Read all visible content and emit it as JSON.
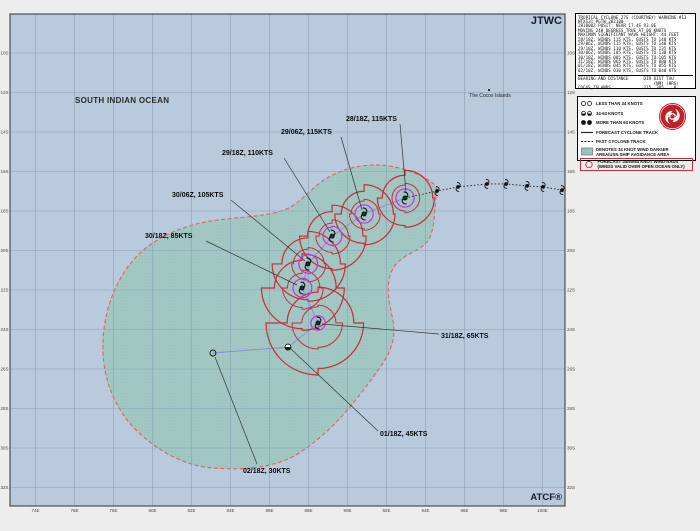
{
  "map_overlays": {
    "jtwc": "JTWC",
    "atcf": "ATCF®",
    "ocean_label": "SOUTH INDIAN OCEAN",
    "cocos_label": "The Cocos Islands"
  },
  "warning_box": {
    "lines": [
      "TROPICAL CYCLONE 27S (COURTNEY) WARNING #13",
      "WTXS31 PGTW 282100",
      "281800Z POSIT: NEAR 17.4S 93.0E",
      "MOVING 240 DEGREES TRUE AT 06 KNOTS",
      "MAXIMUM SIGNIFICANT WAVE HEIGHT: 44 FEET",
      "28/18Z, WINDS 115 KTS, GUSTS TO 140 KTS",
      "29/06Z, WINDS 115 KTS, GUSTS TO 140 KTS",
      "29/18Z, WINDS 110 KTS, GUSTS TO 135 KTS",
      "30/06Z, WINDS 105 KTS, GUSTS TO 130 KTS",
      "30/18Z, WINDS 085 KTS, GUSTS TO 105 KTS",
      "31/18Z, WINDS 065 KTS, GUSTS TO 080 KTS",
      "01/18Z, WINDS 045 KTS, GUSTS TO 055 KTS",
      "02/18Z, WINDS 030 KTS, GUSTS TO 040 KTS"
    ],
    "bearing": {
      "header": "BEARING AND DISTANCE      DIR DIST TAU",
      "units": "                              (NM) (HRS)",
      "row": "COCOS_ISLANDS             215  385    0"
    }
  },
  "legend": {
    "items": [
      {
        "icon": "open-circles",
        "label": "LESS THAN 34 KNOTS"
      },
      {
        "icon": "half-circles",
        "label": "34-63 KNOTS"
      },
      {
        "icon": "filled-circles",
        "label": "MORE THAN 63 KNOTS"
      },
      {
        "icon": "solid-line",
        "label": "FORECAST CYCLONE TRACK"
      },
      {
        "icon": "dashed-line",
        "label": "PAST CYCLONE TRACK"
      },
      {
        "icon": "hatched-box",
        "label": "DENOTES 34 KNOT WIND DANGER\nAREA/USN SHIP AVOIDANCE AREA"
      },
      {
        "icon": "radii-circle",
        "label": "FORECAST 34/50/64 KNOT WIND RADII\n(WINDS VALID OVER OPEN OCEAN ONLY)",
        "boxed": true
      }
    ]
  },
  "chart_data": {
    "type": "cyclone-forecast-track",
    "storm": {
      "id": "27S",
      "name": "COURTNEY",
      "warning_number": 13
    },
    "colors": {
      "map_bg": "#b9cadd",
      "grid": "#8aa0b5",
      "danger_fill": "#a3c8c3",
      "danger_dot": "#7fb0aa",
      "danger_border": "#e2615f",
      "radii_34_50": "#c82c3c",
      "radii_64": "#cf2fd6",
      "forecast_track": "#8691d4",
      "past_track": "#1a1a1a",
      "leader": "#333333"
    },
    "map": {
      "lon_ticks": [
        74,
        76,
        78,
        80,
        82,
        84,
        86,
        88,
        90,
        92,
        94,
        96,
        98,
        100
      ],
      "lat_ticks": [
        10,
        12,
        14,
        16,
        18,
        20,
        22,
        24,
        26,
        28,
        30,
        32
      ],
      "cocos_islands": {
        "lat": 11.97,
        "lon": 97.33
      }
    },
    "past_track": [
      {
        "lon": 94.59,
        "lat": 16.99
      },
      {
        "lon": 95.67,
        "lat": 16.78
      },
      {
        "lon": 97.15,
        "lat": 16.63
      },
      {
        "lon": 98.13,
        "lat": 16.63
      },
      {
        "lon": 99.21,
        "lat": 16.73
      },
      {
        "lon": 100.03,
        "lat": 16.78
      },
      {
        "lon": 101.0,
        "lat": 16.94
      }
    ],
    "forecast": [
      {
        "dtg": "28/18Z",
        "intensity_kt": 115,
        "label": "28/18Z, 115KTS",
        "wind_class": "hurricane",
        "lat": 17.34,
        "lon": 92.95,
        "r34": [
          85,
          90,
          85,
          70
        ],
        "r50": [
          45,
          45,
          40,
          40
        ],
        "r64": [
          28,
          28,
          28,
          28
        ],
        "label_px": [
          346,
          121
        ],
        "leader": [
          [
            400,
            124
          ],
          [
            406,
            193
          ]
        ]
      },
      {
        "dtg": "29/06Z",
        "intensity_kt": 115,
        "label": "29/06Z, 115KTS",
        "wind_class": "hurricane",
        "lat": 18.15,
        "lon": 90.85,
        "r34": [
          90,
          95,
          90,
          70
        ],
        "r50": [
          45,
          50,
          45,
          40
        ],
        "r64": [
          28,
          28,
          28,
          28
        ],
        "label_px": [
          281,
          134
        ],
        "leader": [
          [
            341,
            137
          ],
          [
            362,
            210
          ]
        ]
      },
      {
        "dtg": "29/18Z",
        "intensity_kt": 110,
        "label": "29/18Z, 110KTS",
        "wind_class": "hurricane",
        "lat": 19.27,
        "lon": 89.21,
        "r34": [
          95,
          105,
          100,
          75
        ],
        "r50": [
          50,
          55,
          50,
          40
        ],
        "r64": [
          30,
          30,
          28,
          28
        ],
        "label_px": [
          222,
          155
        ],
        "leader": [
          [
            284,
            158
          ],
          [
            330,
            232
          ]
        ]
      },
      {
        "dtg": "30/06Z",
        "intensity_kt": 105,
        "label": "30/06Z, 105KTS",
        "wind_class": "hurricane",
        "lat": 20.68,
        "lon": 87.97,
        "r34": [
          100,
          115,
          110,
          80
        ],
        "r50": [
          50,
          55,
          50,
          45
        ],
        "r64": [
          30,
          30,
          28,
          28
        ],
        "label_px": [
          172,
          197
        ],
        "leader": [
          [
            231,
            200
          ],
          [
            305,
            261
          ]
        ]
      },
      {
        "dtg": "30/18Z",
        "intensity_kt": 85,
        "label": "30/18Z, 85KTS",
        "wind_class": "hurricane",
        "lat": 21.9,
        "lon": 87.67,
        "r34": [
          105,
          130,
          125,
          85
        ],
        "r50": [
          55,
          65,
          60,
          45
        ],
        "r64": [
          30,
          30,
          28,
          28
        ],
        "label_px": [
          145,
          238
        ],
        "leader": [
          [
            206,
            241
          ],
          [
            297,
            285
          ]
        ]
      },
      {
        "dtg": "31/18Z",
        "intensity_kt": 65,
        "label": "31/18Z, 65KTS",
        "wind_class": "hurricane",
        "lat": 23.67,
        "lon": 88.49,
        "r34": [
          110,
          140,
          160,
          95
        ],
        "r50": [
          55,
          75,
          80,
          50
        ],
        "r64": [
          22,
          22,
          22,
          22
        ],
        "label_px": [
          441,
          338
        ],
        "leader": [
          [
            439,
            334
          ],
          [
            322,
            324
          ]
        ]
      },
      {
        "dtg": "01/18Z",
        "intensity_kt": 45,
        "label": "01/18Z, 45KTS",
        "wind_class": "storm",
        "lat": 24.89,
        "lon": 86.95,
        "r34": null,
        "r50": null,
        "r64": null,
        "label_px": [
          380,
          436
        ],
        "leader": [
          [
            378,
            431
          ],
          [
            291,
            349
          ]
        ]
      },
      {
        "dtg": "02/18Z",
        "intensity_kt": 30,
        "label": "02/18Z, 30KTS",
        "wind_class": "depression",
        "lat": 25.19,
        "lon": 83.1,
        "r34": null,
        "r50": null,
        "r64": null,
        "label_px": [
          243,
          473
        ],
        "leader": [
          [
            257,
            464
          ],
          [
            215,
            357
          ]
        ]
      }
    ],
    "layout": {
      "mx": 10,
      "my": 14,
      "mw": 555,
      "mh": 492,
      "x0": 35.5,
      "lon0": 74,
      "ppdx": 19.5,
      "y0": 53,
      "lat0": 10,
      "ppdy": 19.75,
      "danger_path": "M437,190 C434,205 436,222 430,237 C424,250 408,252 398,262 C388,272 387,287 389,300 C391,315 396,325 393,340 C390,356 377,372 362,392 C345,414 322,440 294,456 C270,469 240,470 213,468 C186,466 158,452 136,430 C116,410 104,382 103,352 C102,322 110,290 130,264 C148,241 176,228 205,222 C232,217 258,218 281,211 C298,206 306,193 320,183 C334,172 352,166 372,165 C394,164 414,172 425,178 C432,182 436,185 437,190 Z"
    }
  }
}
